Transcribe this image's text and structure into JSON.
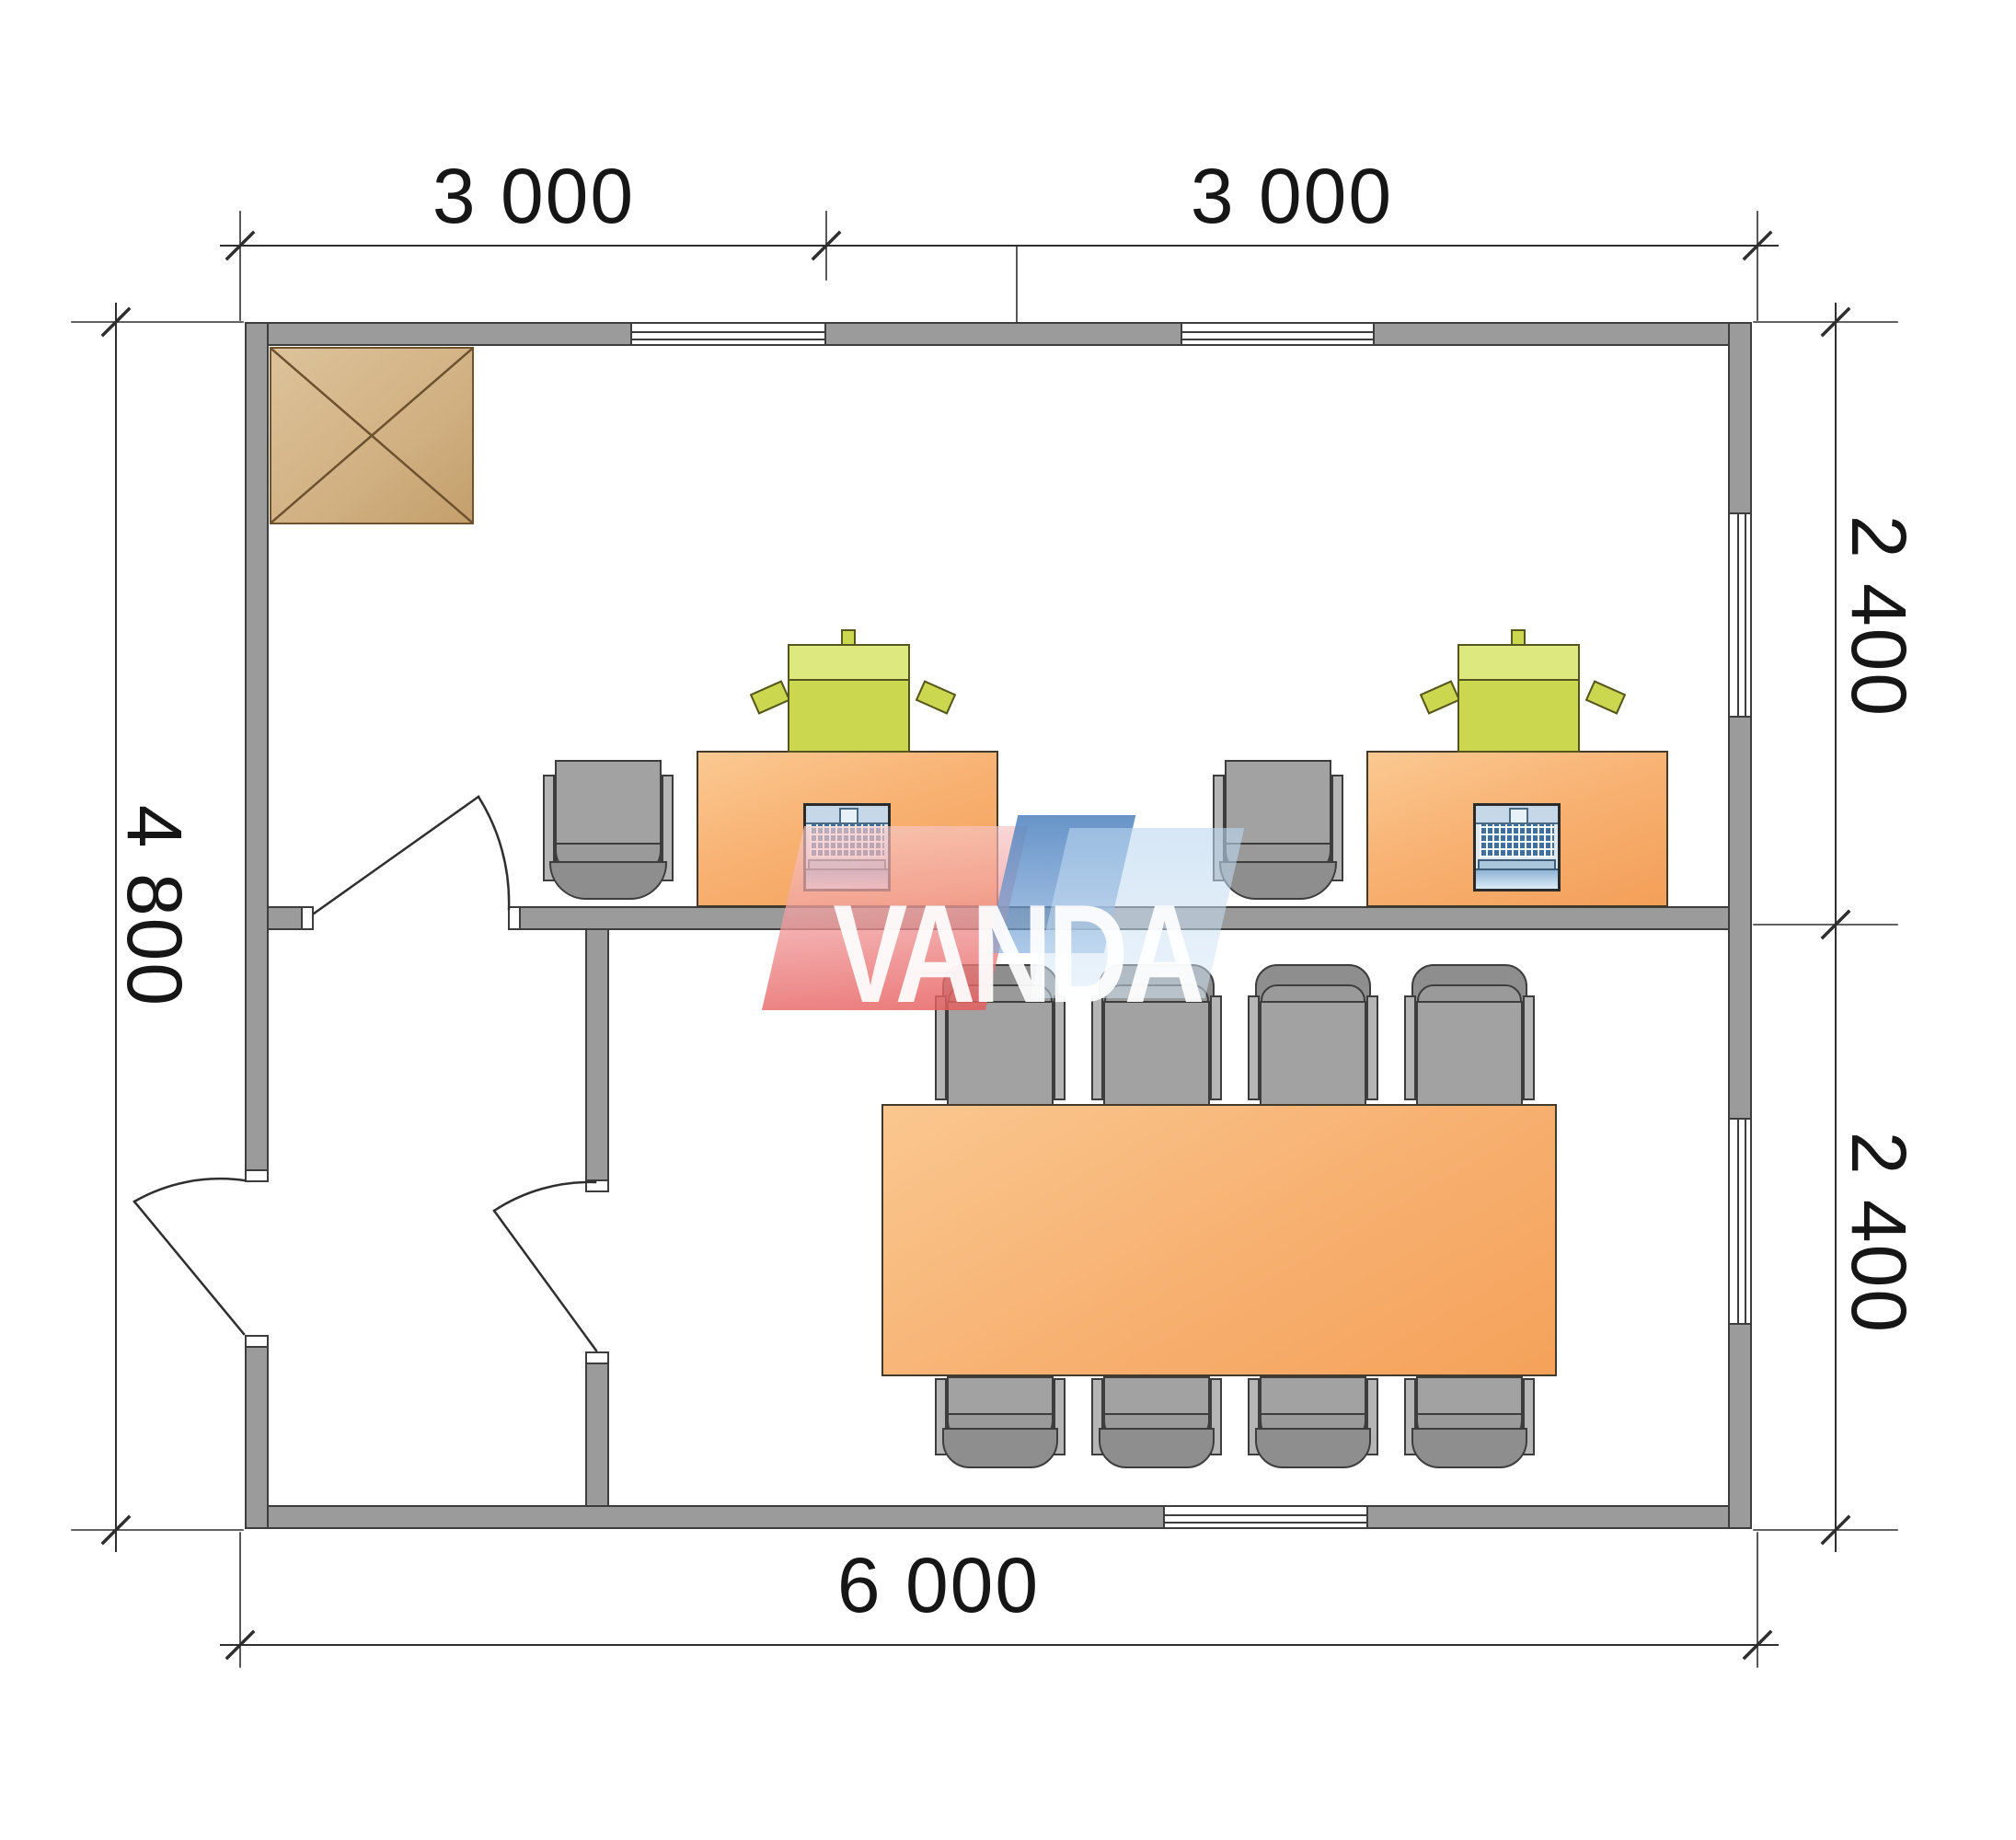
{
  "watermark": {
    "text": "VANDA",
    "pink": "#ec8383",
    "blue": "#5b9bd5"
  },
  "dimensions": {
    "top": [
      "3 000",
      "3 000"
    ],
    "right": [
      "2 400",
      "2 400"
    ],
    "bottom": [
      "6 000"
    ],
    "left": [
      "4 800"
    ]
  },
  "colors": {
    "wall_gray": "#9b9b9b",
    "furniture_orange": "#f7b071",
    "equipment_green": "#cbd74f",
    "chair_gray": "#a2a2a2",
    "column_tan": "#d2b284"
  }
}
